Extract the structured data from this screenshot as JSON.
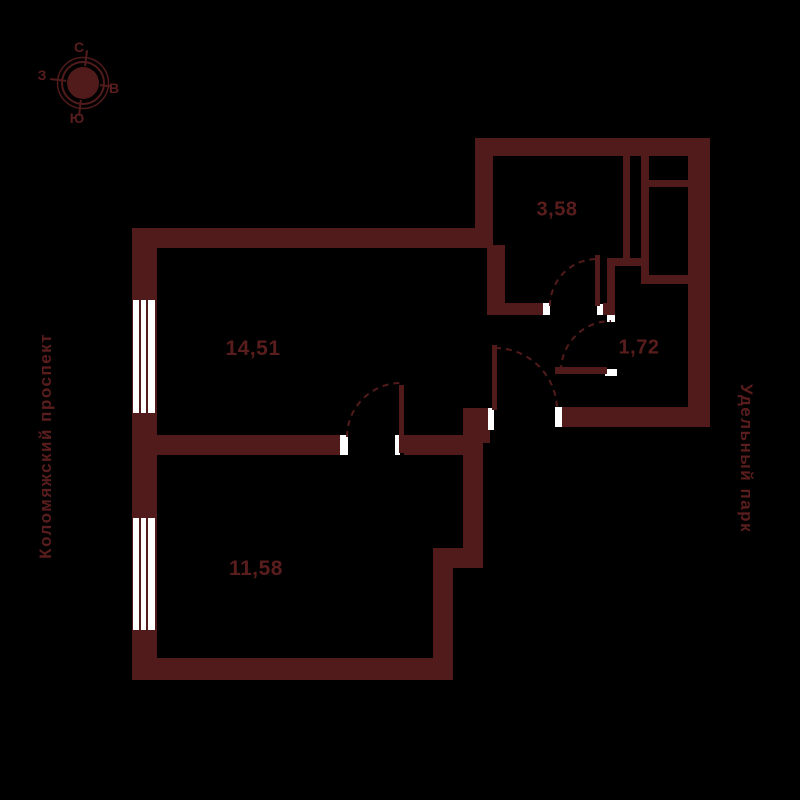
{
  "plan": {
    "rooms": {
      "living_room": {
        "area": "14,51"
      },
      "bedroom": {
        "area": "11,58"
      },
      "bathroom": {
        "area": "3,58"
      },
      "wc": {
        "area": "1,72"
      }
    },
    "streets": {
      "left": "Коломяжский проспект",
      "right": "Удельный парк"
    },
    "compass": {
      "north": "С",
      "east": "В",
      "south": "Ю",
      "west": "З"
    },
    "colors": {
      "wall": "#521b1b",
      "label": "#5a1d1d",
      "opening": "#ffffff",
      "background": "#000000"
    }
  }
}
